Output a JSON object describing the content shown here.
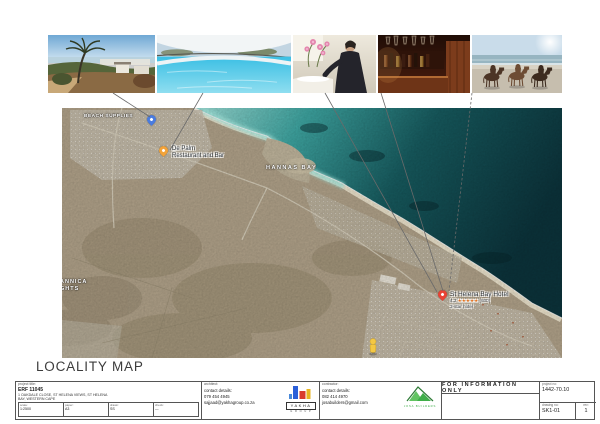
{
  "sheet": {
    "heading": "LOCALITY MAP",
    "for_information": "FOR INFORMATION ONLY"
  },
  "photos": [
    {
      "name": "hotel-exterior-view"
    },
    {
      "name": "swimming-pool"
    },
    {
      "name": "spa-treatment"
    },
    {
      "name": "hotel-bar"
    },
    {
      "name": "horse-riding-on-beach"
    }
  ],
  "map": {
    "labels": {
      "store": "BEACH SUPPLIES",
      "bay": "HANNAS BAY",
      "suburb_line1": "ANNICA",
      "suburb_line2": "GHTS"
    },
    "restaurant_poi": {
      "line1": "De Palm",
      "line2": "Restaurant and Bar"
    },
    "hotel_poi": {
      "name": "St Helena Bay Hotel",
      "rating": "4,2",
      "stars": "★★★★★",
      "reviews": "(600)",
      "category": "3-star hotel"
    }
  },
  "titleblock": {
    "project": {
      "header": "project title:",
      "erf": "ERF 11045",
      "address1": "1 OAKDALE CLOSE, ST HELENA VIEWS, ST HELENA",
      "address2": "BAY, WESTERN CAPE",
      "cols": [
        {
          "label": "scale:",
          "value": "1:2500"
        },
        {
          "label": "paper:",
          "value": "A3"
        },
        {
          "label": "drawn:",
          "value": "SS"
        },
        {
          "label": "check:",
          "value": "—"
        }
      ]
    },
    "architect": {
      "header": "architect:",
      "contact_label": "contact details:",
      "phone": "079 454 4945",
      "email": "sajjaad@yakhagroup.co.za",
      "logo_name": "YAKHA",
      "logo_sub": "G R O U P"
    },
    "contractor": {
      "header": "contractor:",
      "contact_label": "contact details:",
      "phone": "082 414 4970",
      "email": "josabuilders@gmail.com",
      "logo_line": "JOSA BUILDERS"
    },
    "numbers": {
      "project_no_label": "project no:",
      "project_no": "1442-70.10",
      "drawing_no_label": "drawing no:",
      "drawing_no": "SK1-01",
      "rev_label": "rev:",
      "rev": "1"
    }
  }
}
